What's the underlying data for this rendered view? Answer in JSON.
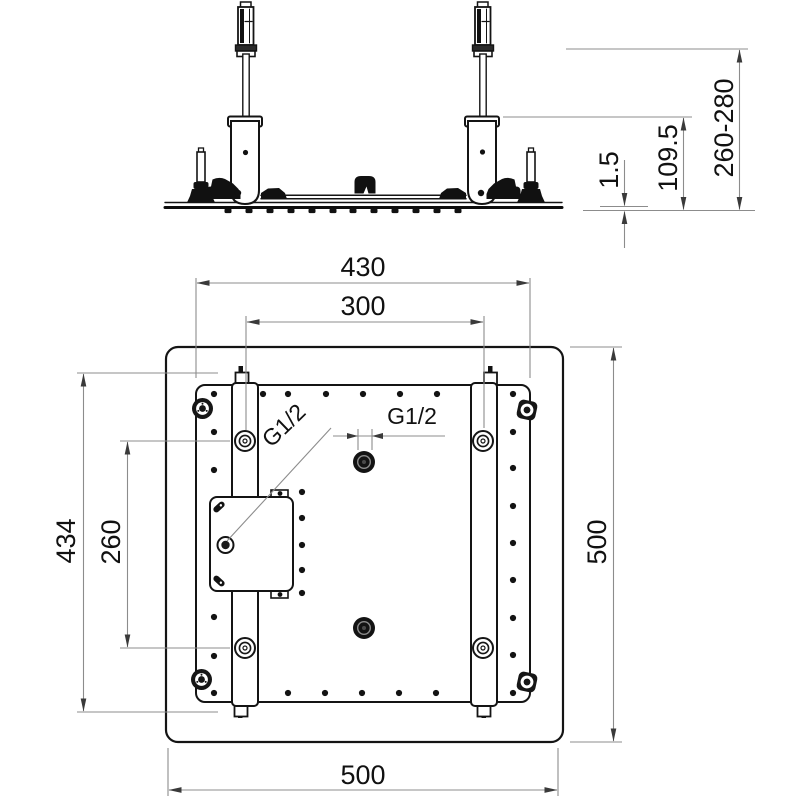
{
  "drawing": {
    "background": "#ffffff",
    "line_color": "#141414",
    "dim_line_color": "#8c8c8c",
    "arrow_color": "#3a3a3a",
    "text_color": "#111111",
    "side_view": {
      "plate_thickness": "1.5",
      "housing_height": "109.5",
      "overall_height_range": "260-280"
    },
    "plan_view": {
      "inner_width": "430",
      "hanger_spacing": "300",
      "inner_height": "434",
      "fixing_hole_spacing": "260",
      "outer_height": "500",
      "outer_width": "500",
      "thread_label_left": "G1/2",
      "thread_label_center": "G1/2"
    }
  }
}
